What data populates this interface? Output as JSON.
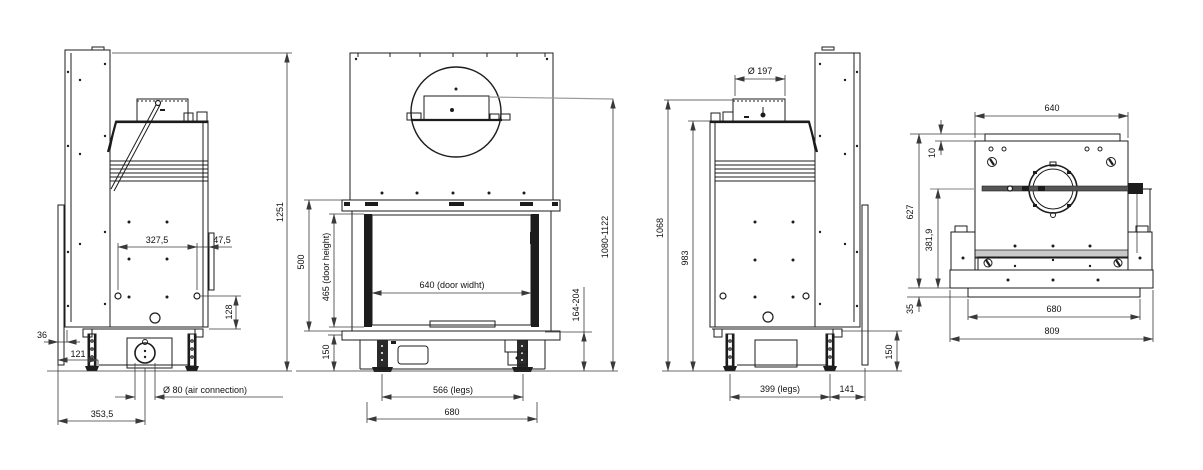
{
  "drawing": {
    "background": "#ffffff",
    "line_color": "#1c1c1c",
    "dim_color": "#3a3a3a",
    "ref_line_color": "#9a9a9a",
    "views": {
      "side_a": {
        "dims": {
          "total_height": "1251",
          "holes_spacing": "327,5",
          "bracket_offset": "47,5",
          "hole_height": "128",
          "front_gap": "36",
          "leg_offset": "121",
          "air_connection": "Ø 80 (air connection)",
          "air_center": "353,5"
        }
      },
      "front": {
        "dims": {
          "frame_height": "500",
          "door_height": "465 (door height)",
          "door_width": "640 (door widht)",
          "overall_height": "1080-1122",
          "hearth_clearance": "164-204",
          "base_height": "150",
          "legs_spacing": "566 (legs)",
          "body_width": "680"
        }
      },
      "side_b": {
        "dims": {
          "flue_diameter": "Ø 197",
          "height_to_collar": "1068",
          "height_to_top": "983",
          "legs_spacing": "399 (legs)",
          "rear_offset": "141",
          "base_height": "150"
        }
      },
      "rear": {
        "dims": {
          "body_width": "640",
          "plate_offset": "10",
          "rear_height": "627",
          "damper_height": "381,9",
          "plinth_height": "35",
          "inner_width": "680",
          "base_width": "809"
        }
      }
    }
  }
}
